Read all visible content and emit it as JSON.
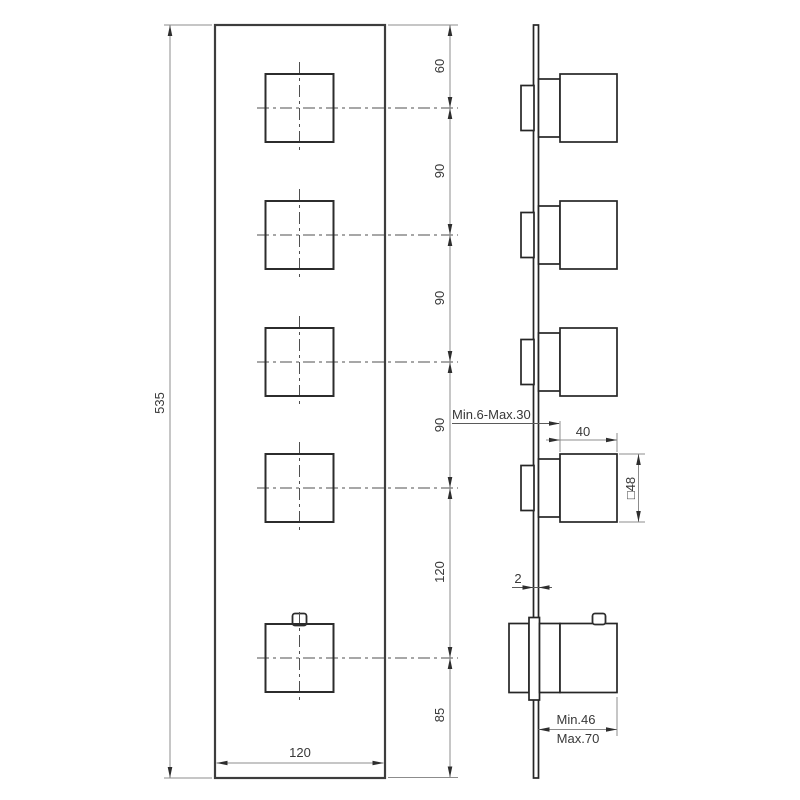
{
  "drawing": {
    "front_view": {
      "overall_height": "535",
      "plate_width": "120",
      "vertical_spacings": [
        "60",
        "90",
        "90",
        "90",
        "120",
        "85"
      ]
    },
    "side_view": {
      "wall_thickness_range": "Min.6-Max.30",
      "handle_width": "40",
      "handle_square": "□48",
      "plate_thickness": "2",
      "projection_min": "Min.46",
      "projection_max": "Max.70"
    },
    "line_color": "#2e2e2e",
    "background_color": "#ffffff"
  }
}
